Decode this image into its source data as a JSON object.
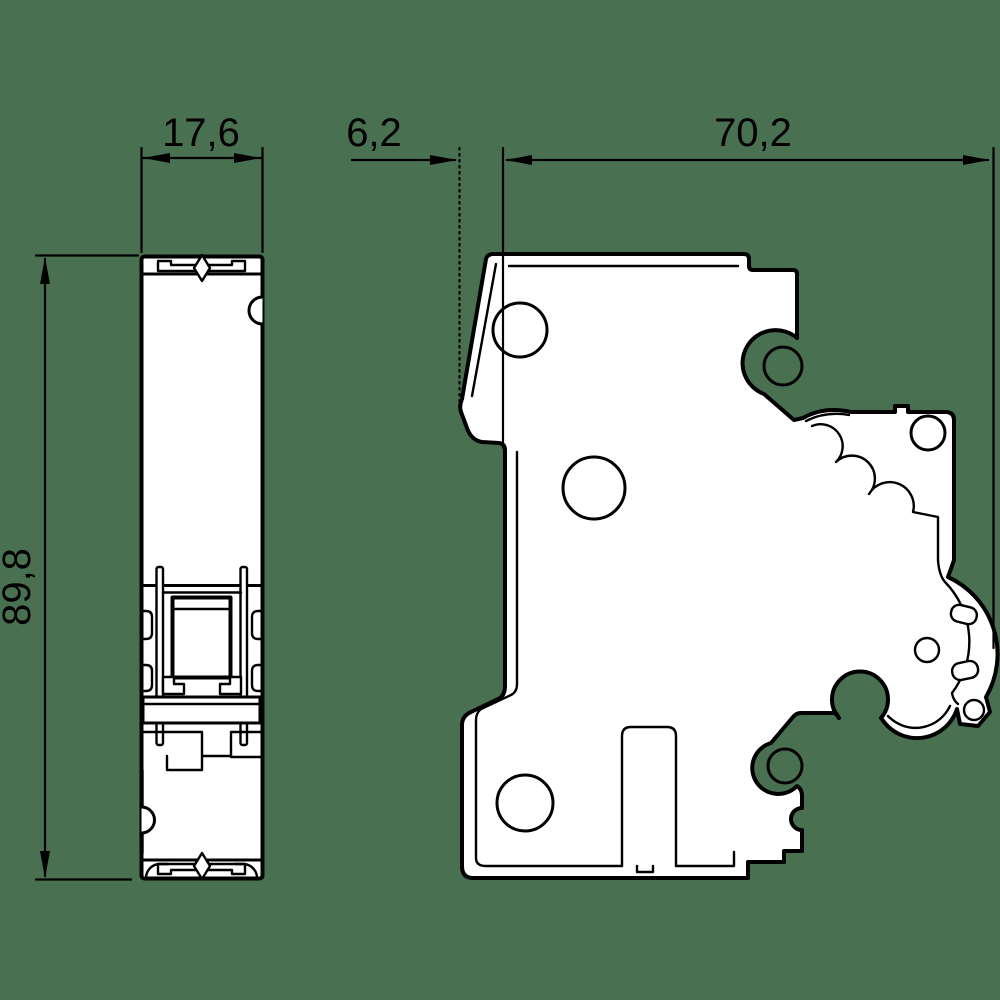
{
  "drawing": {
    "background_color": "#4a7052",
    "line_color": "#000000",
    "fill_color": "#ffffff",
    "dimensions": {
      "front_width": "17,6",
      "mount_offset": "6,2",
      "depth": "70,2",
      "height": "89,8"
    }
  }
}
